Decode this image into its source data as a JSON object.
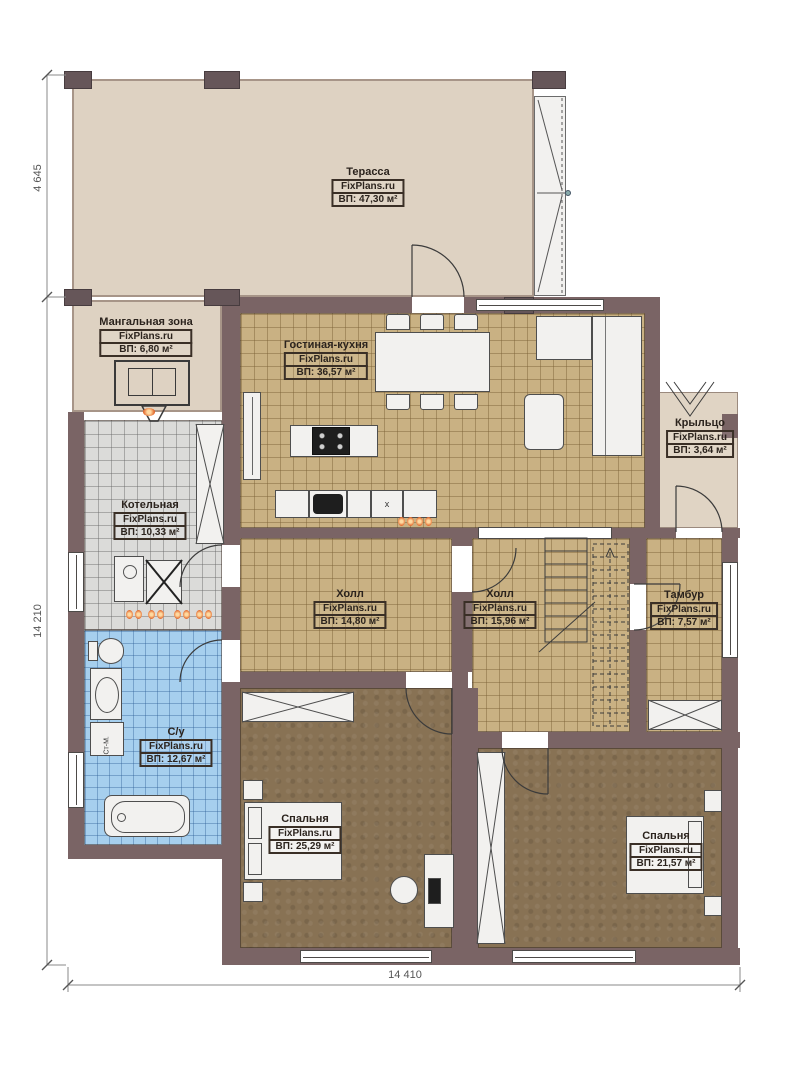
{
  "meta": {
    "brand": "FixPlans.ru"
  },
  "rooms": [
    {
      "id": "terrace",
      "name": "Терасса",
      "area": "ВП: 47,30 м²"
    },
    {
      "id": "bbq-zone",
      "name": "Мангальная зона",
      "area": "ВП: 6,80 м²"
    },
    {
      "id": "living-kitchen",
      "name": "Гостиная-кухня",
      "area": "ВП: 36,57 м²"
    },
    {
      "id": "porch",
      "name": "Крыльцо",
      "area": "ВП: 3,64 м²"
    },
    {
      "id": "boiler-room",
      "name": "Котельная",
      "area": "ВП: 10,33 м²"
    },
    {
      "id": "hall-1",
      "name": "Холл",
      "area": "ВП: 14,80 м²"
    },
    {
      "id": "hall-2",
      "name": "Холл",
      "area": "ВП: 15,96 м²"
    },
    {
      "id": "tambour",
      "name": "Тамбур",
      "area": "ВП: 7,57 м²"
    },
    {
      "id": "bathroom",
      "name": "С/у",
      "area": "ВП: 12,67 м²"
    },
    {
      "id": "bedroom-1",
      "name": "Спальня",
      "area": "ВП: 25,29 м²"
    },
    {
      "id": "bedroom-2",
      "name": "Спальня",
      "area": "ВП: 21,57 м²"
    }
  ],
  "dimensions": {
    "left_top": "4 645",
    "left_main": "14 210",
    "bottom": "14 410"
  },
  "equipment_labels": {
    "washing_machine": "Ст-М.",
    "dishwasher": "x"
  },
  "colors": {
    "wall": "#7a6465",
    "wood_floor": "#c9b183",
    "gray_tile": "#dbdbd9",
    "blue_tile": "#a6cfee",
    "carpet": "#887254",
    "beige": "#ded2c2",
    "accent": "#e06a28"
  }
}
